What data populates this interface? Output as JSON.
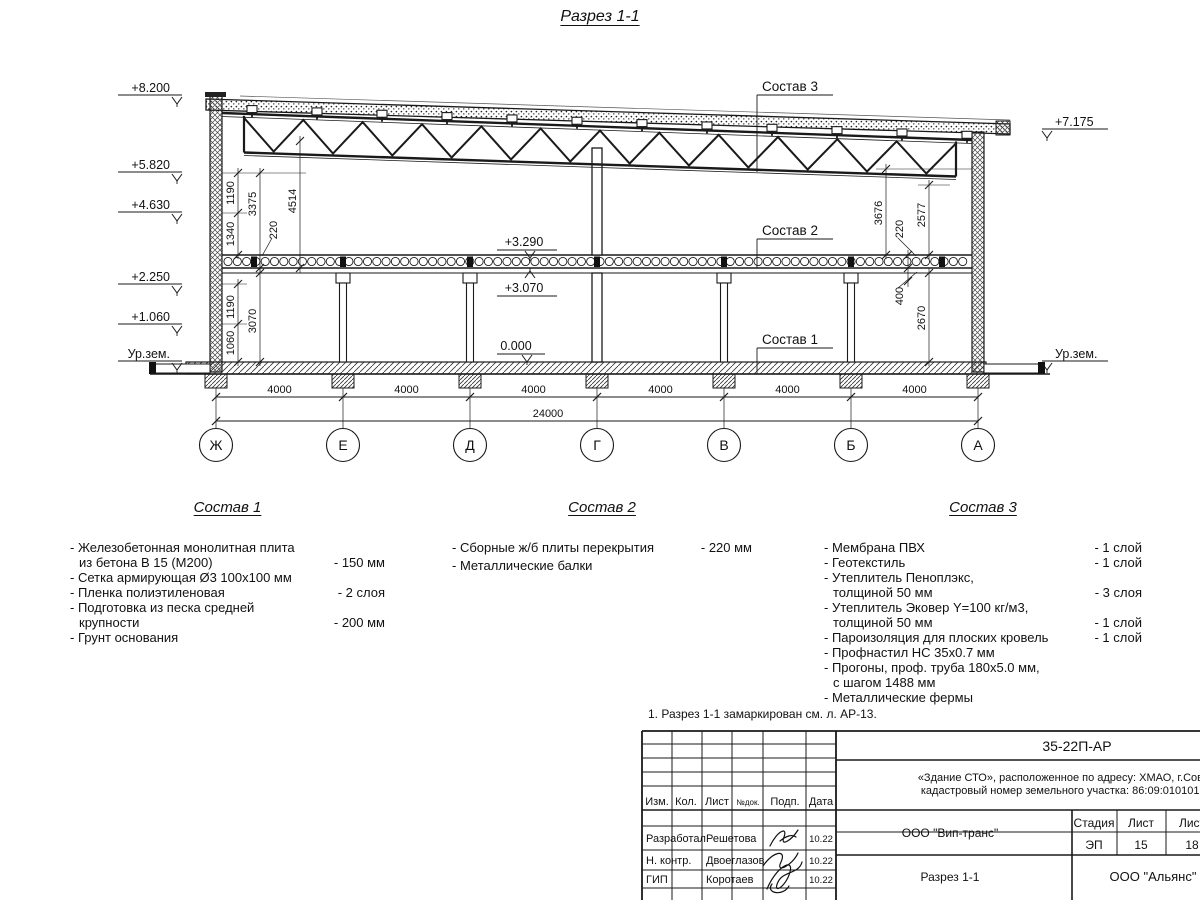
{
  "title": "Разрез 1-1",
  "note": "1. Разрез 1-1 замаркирован см. л. АР-13.",
  "drawing": {
    "marks_left": [
      "+8.200",
      "+5.820",
      "+4.630",
      "+2.250",
      "+1.060",
      "Ур.зем."
    ],
    "marks_right": [
      "+7.175",
      "Ур.зем."
    ],
    "marks_inner": [
      "+3.290",
      "+3.070",
      "0.000"
    ],
    "callouts": [
      "Состав 3",
      "Состав 2",
      "Состав 1"
    ],
    "dims_left": [
      "1190",
      "1340",
      "3375",
      "4514",
      "220",
      "1190",
      "1060",
      "3070"
    ],
    "dims_right": [
      "3676",
      "2577",
      "220",
      "400",
      "2670"
    ],
    "dims_bottom": [
      "4000",
      "4000",
      "4000",
      "4000",
      "4000",
      "4000"
    ],
    "dim_total": "24000",
    "axes": [
      "Ж",
      "Е",
      "Д",
      "Г",
      "В",
      "Б",
      "А"
    ]
  },
  "sostav1": {
    "title": "Состав 1",
    "items": [
      {
        "lines": [
          "- Железобетонная  монолитная плита",
          "из бетона В 15 (М200)"
        ],
        "value": "- 150 мм"
      },
      {
        "lines": [
          "- Сетка армирующая Ø3 100х100 мм"
        ],
        "value": ""
      },
      {
        "lines": [
          "- Пленка полиэтиленовая"
        ],
        "value": "- 2 слоя"
      },
      {
        "lines": [
          "- Подготовка из песка средней",
          "крупности"
        ],
        "value": "- 200 мм"
      },
      {
        "lines": [
          "- Грунт основания"
        ],
        "value": ""
      }
    ]
  },
  "sostav2": {
    "title": "Состав 2",
    "items": [
      {
        "lines": [
          "- Сборные ж/б плиты перекрытия"
        ],
        "value": "- 220 мм"
      },
      {
        "lines": [
          "- Металлические балки"
        ],
        "value": ""
      }
    ]
  },
  "sostav3": {
    "title": "Состав 3",
    "items": [
      {
        "lines": [
          "- Мембрана ПВХ"
        ],
        "value": "- 1 слой"
      },
      {
        "lines": [
          "- Геотекстиль"
        ],
        "value": "- 1 слой"
      },
      {
        "lines": [
          "- Утеплитель Пеноплэкс,",
          "толщиной 50 мм"
        ],
        "value": "- 3 слоя"
      },
      {
        "lines": [
          "- Утеплитель Эковер Y=100 кг/м3,",
          "толщиной 50 мм"
        ],
        "value": "- 1 слой"
      },
      {
        "lines": [
          "- Пароизоляция для плоских кровель"
        ],
        "value": "- 1 слой"
      },
      {
        "lines": [
          "- Профнастил НС 35х0.7 мм"
        ],
        "value": ""
      },
      {
        "lines": [
          "- Прогоны, проф. труба 180х5.0 мм,",
          "с шагом 1488 мм"
        ],
        "value": ""
      },
      {
        "lines": [
          "- Металлические фермы"
        ],
        "value": ""
      }
    ]
  },
  "stamp": {
    "doc_number": "35-22П-АР",
    "object_line1": "«Здание СТО», расположенное по адресу: ХМАО, г.Советский",
    "object_line2": "кадастровый номер земельного участка: 86:09:0101016:1502",
    "cols": [
      "Изм.",
      "Кол.",
      "Лист",
      "№док.",
      "Подп.",
      "Дата"
    ],
    "rows": [
      {
        "role": "Разработал",
        "name": "Решетова",
        "date": "10.22"
      },
      {
        "role": "Н. контр.",
        "name": "Двоеглазов",
        "date": "10.22"
      },
      {
        "role": "ГИП",
        "name": "Коротаев",
        "date": "10.22"
      }
    ],
    "org_mid": "ООО \"Вип-транс\"",
    "sheet_name": "Разрез 1-1",
    "org_right": "ООО \"Альянс\"",
    "stage_label": "Стадия",
    "sheet_label": "Лист",
    "sheets_label": "Лист",
    "stage": "ЭП",
    "sheet": "15",
    "sheets": "18"
  },
  "colors": {
    "line": "#1a1a1a",
    "paper": "#ffffff"
  }
}
